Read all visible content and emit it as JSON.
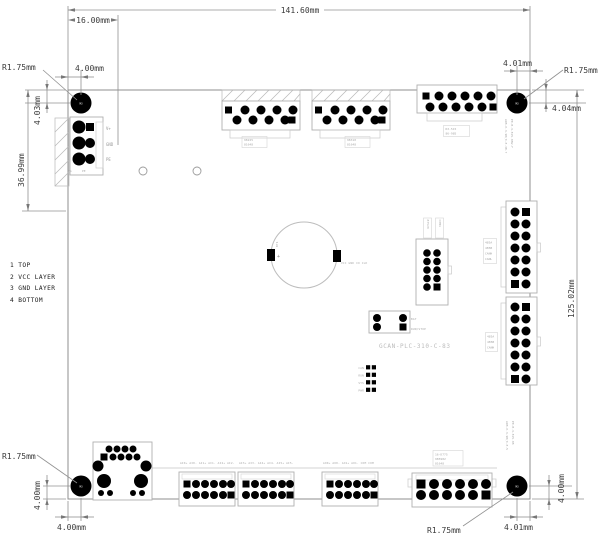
{
  "drawing": {
    "title": "GCAN-PLC-310-C-83",
    "legend": [
      "1  TOP",
      "2  VCC LAYER",
      "3  GND LAYER",
      "4  BOTTOM"
    ],
    "hole_mark": "M3",
    "dims": {
      "width": "141.60mm",
      "inset": "16.00mm",
      "height": "125.02mm",
      "tl": {
        "r": "R1.75mm",
        "x": "4.00mm",
        "y": "4.03mm",
        "span": "36.99mm"
      },
      "tr": {
        "r": "R1.75mm",
        "x": "4.01mm",
        "y": "4.04mm"
      },
      "bl": {
        "r": "R1.75mm",
        "x": "4.00mm",
        "y": "4.00mm"
      },
      "br": {
        "r": "R1.75mm",
        "x": "4.01mm",
        "y": "4.00mm"
      }
    },
    "power": {
      "p1": "V+",
      "p2": "GND",
      "p3": "PE",
      "s1": "FG",
      "s2": "PE"
    },
    "battery": {
      "des": "BT1",
      "plus": "+",
      "pins": "VCC  GND  IO  CLK"
    },
    "jumper": {
      "a": "BAT",
      "b": "RUN/STOP"
    },
    "leds": {
      "a": "CAN",
      "b": "RUN",
      "c": "SYS",
      "d": "PWR"
    },
    "pinrows": {
      "e": "AI0+ AI0- AI1+ AI1- AI2+ AI2-",
      "f": "AI3+ AI3- AI4+ AI4- AI5+ AI5-",
      "g": "AO0+ AO0- AO1+ AO1- COM  COM"
    },
    "micro": {
      "t1": [
        "98225",
        "81648"
      ],
      "t2": [
        "98310",
        "81648"
      ],
      "t3": [
        "R3-515",
        "86-985"
      ],
      "t4": [
        "83520",
        "C0M1"
      ],
      "t5": [
        "485A",
        "485B",
        "CANH",
        "CANL"
      ],
      "t6": [
        "485A",
        "485B",
        "CANH"
      ],
      "t7": [
        "16-D775",
        "985982",
        "81648"
      ],
      "v1": "A9B.0-3.9B(0.8.3B.7",
      "v1b": "P8.B-3.815.0BW.F",
      "v2": "A9B.0-3.9B(0.8.5",
      "v2b": "P8.B-3.815.0B"
    },
    "colors": {
      "pad": "#000000",
      "line": "#9a9a9a",
      "outline": "#b0b0b0",
      "silk_text": "#bcbcbc"
    }
  }
}
